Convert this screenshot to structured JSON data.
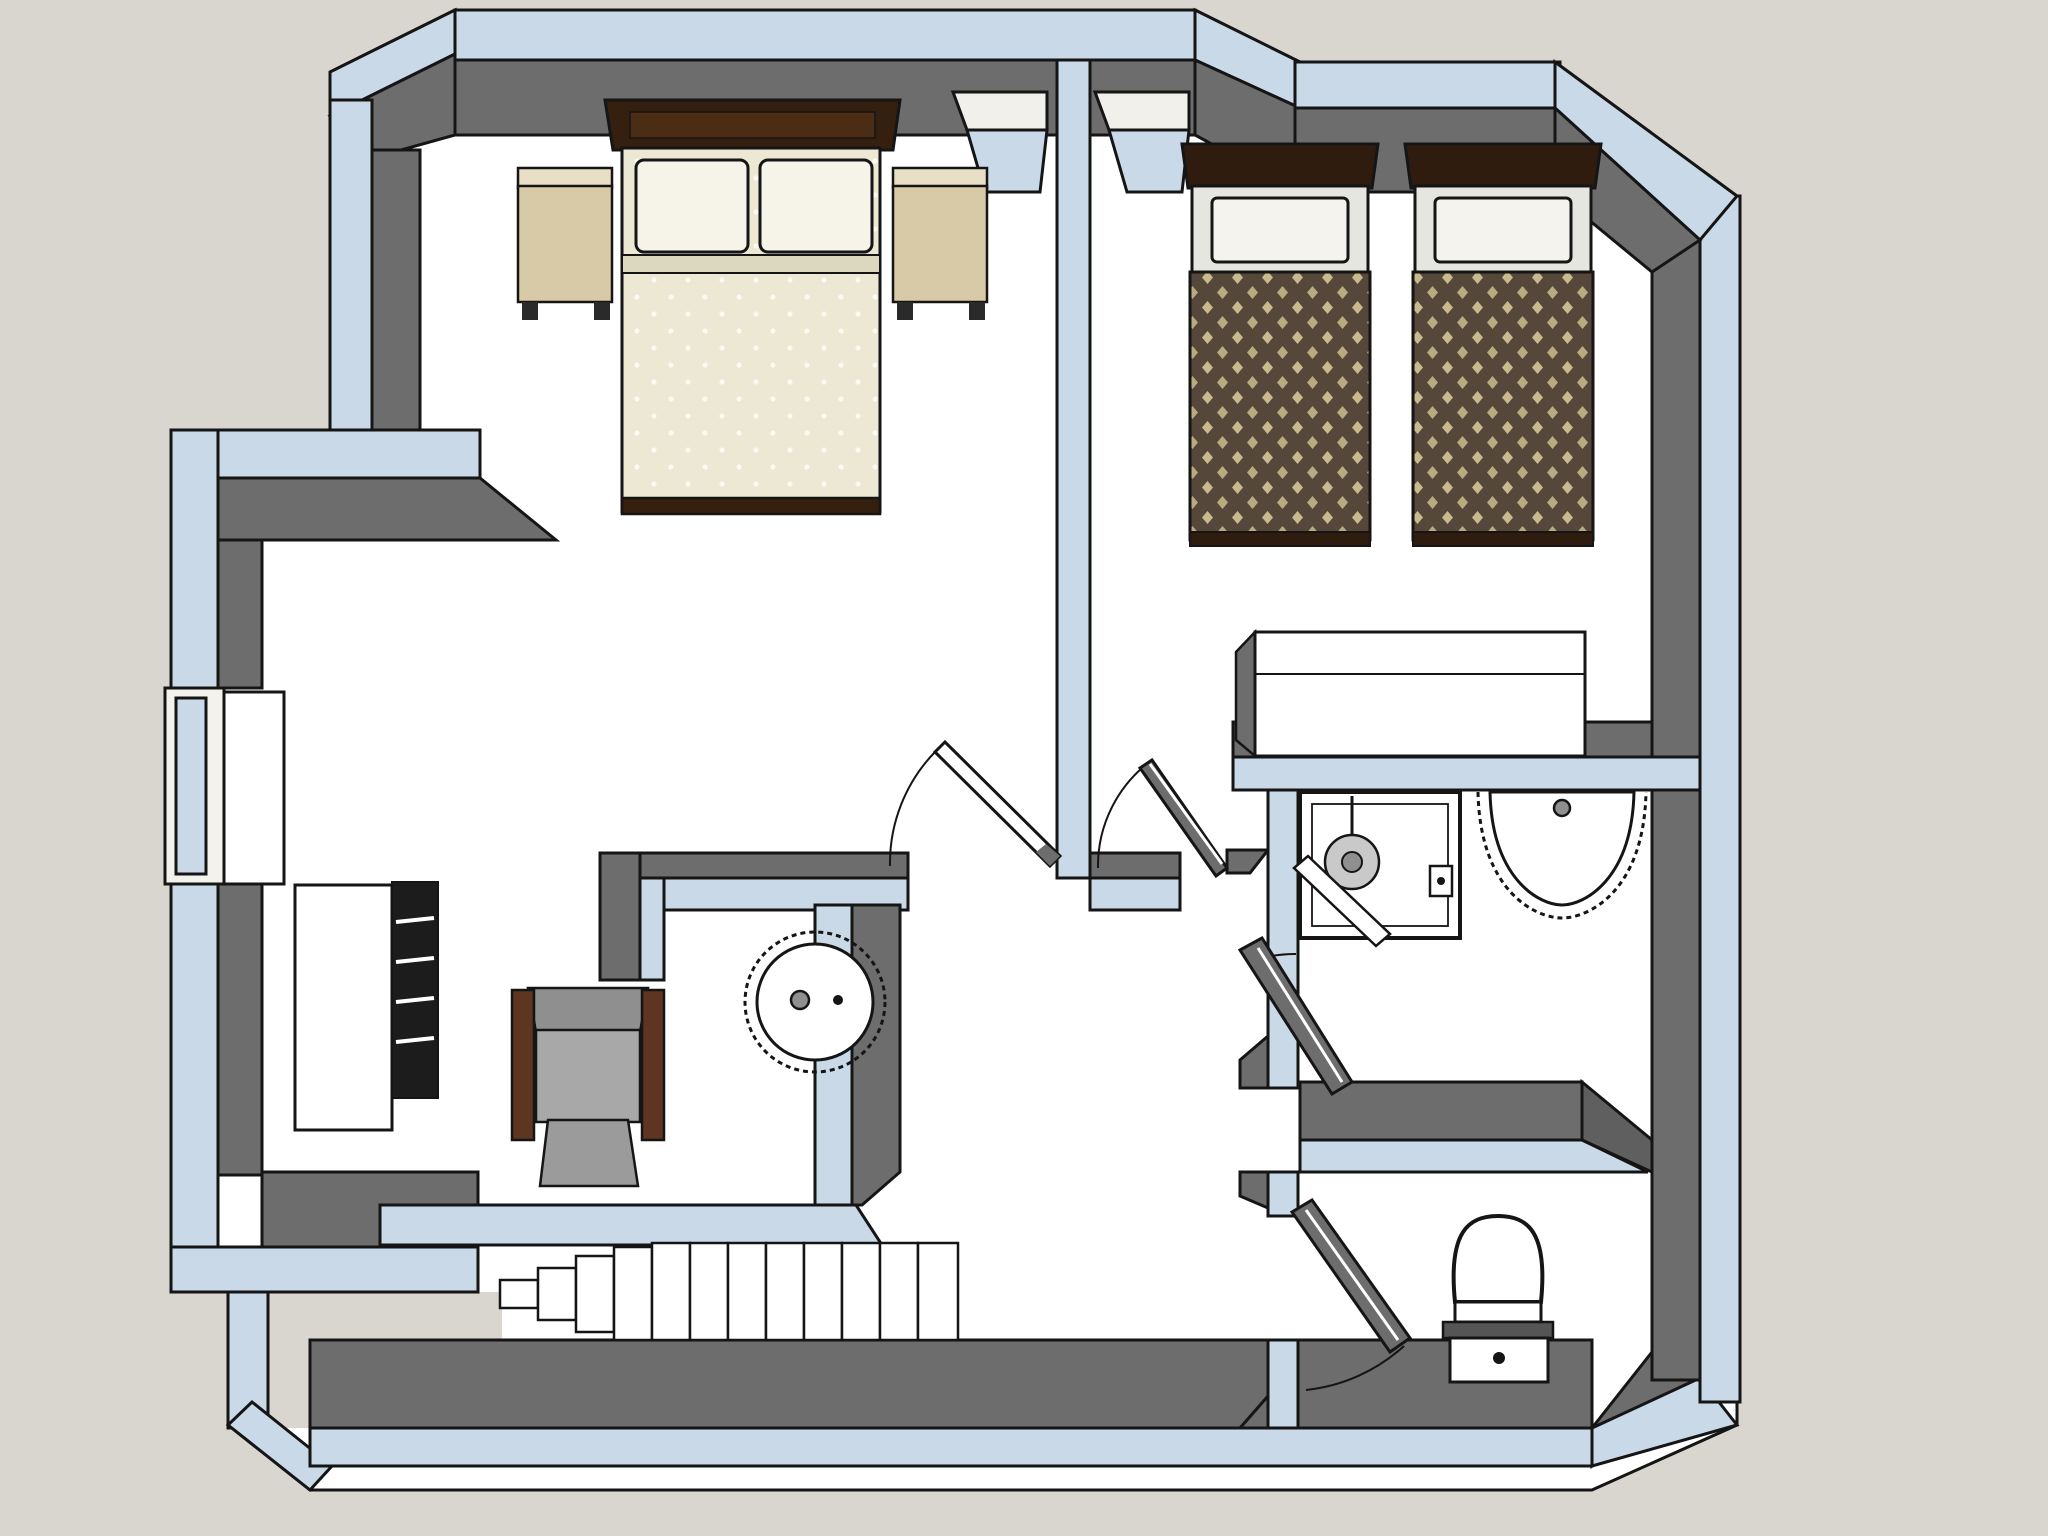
{
  "meta": {
    "app": "3d-floor-plan-viewer",
    "view": "top-down cutaway axonometric floor plan",
    "floor": "upper floor",
    "visible_text": ""
  },
  "palette": {
    "background": "#d9d6d0",
    "wall_top_cut": "#c9d9e7",
    "wall_inner_face": "#6d6d6d",
    "floor": "#ffffff",
    "outline": "#151515",
    "bed_cream": "#ece8d4",
    "pillow_white": "#f6f4e8",
    "duvet_brown": "#55483a",
    "duvet_diamond_tan": "#c9ba8e",
    "wood_dark_brown": "#35200f",
    "nightstand_tan": "#d8c9a7",
    "chair_gray": "#9f9f9f",
    "armrest_brown": "#5d3520",
    "fixture_gray": "#c9c9c9"
  },
  "rooms": [
    {
      "id": "bedroom-1",
      "label": "master bedroom (left)",
      "furniture": [
        "double-bed",
        "pillow x2",
        "nightstand-left",
        "nightstand-right",
        "desk",
        "radiator-railing",
        "armchair",
        "round-wash-basin",
        "window-west",
        "window-north-left"
      ]
    },
    {
      "id": "bedroom-2",
      "label": "twin bedroom (right)",
      "furniture": [
        "twin-bed-1",
        "twin-bed-2",
        "pillow x2",
        "wardrobe",
        "window-north-right"
      ]
    },
    {
      "id": "bathroom",
      "label": "shower room",
      "furniture": [
        "shower-stall",
        "shower-head",
        "wall-sink",
        "door"
      ]
    },
    {
      "id": "wc",
      "label": "toilet room",
      "furniture": [
        "toilet",
        "door"
      ]
    },
    {
      "id": "hallway",
      "label": "stair hall",
      "furniture": [
        "staircase-13-steps",
        "bedroom-door-1",
        "bedroom-door-2"
      ]
    }
  ],
  "counts": {
    "windows": 3,
    "door_leaves": 4,
    "stair_steps": 12,
    "beds": 3,
    "sinks": 2
  },
  "caption": ""
}
